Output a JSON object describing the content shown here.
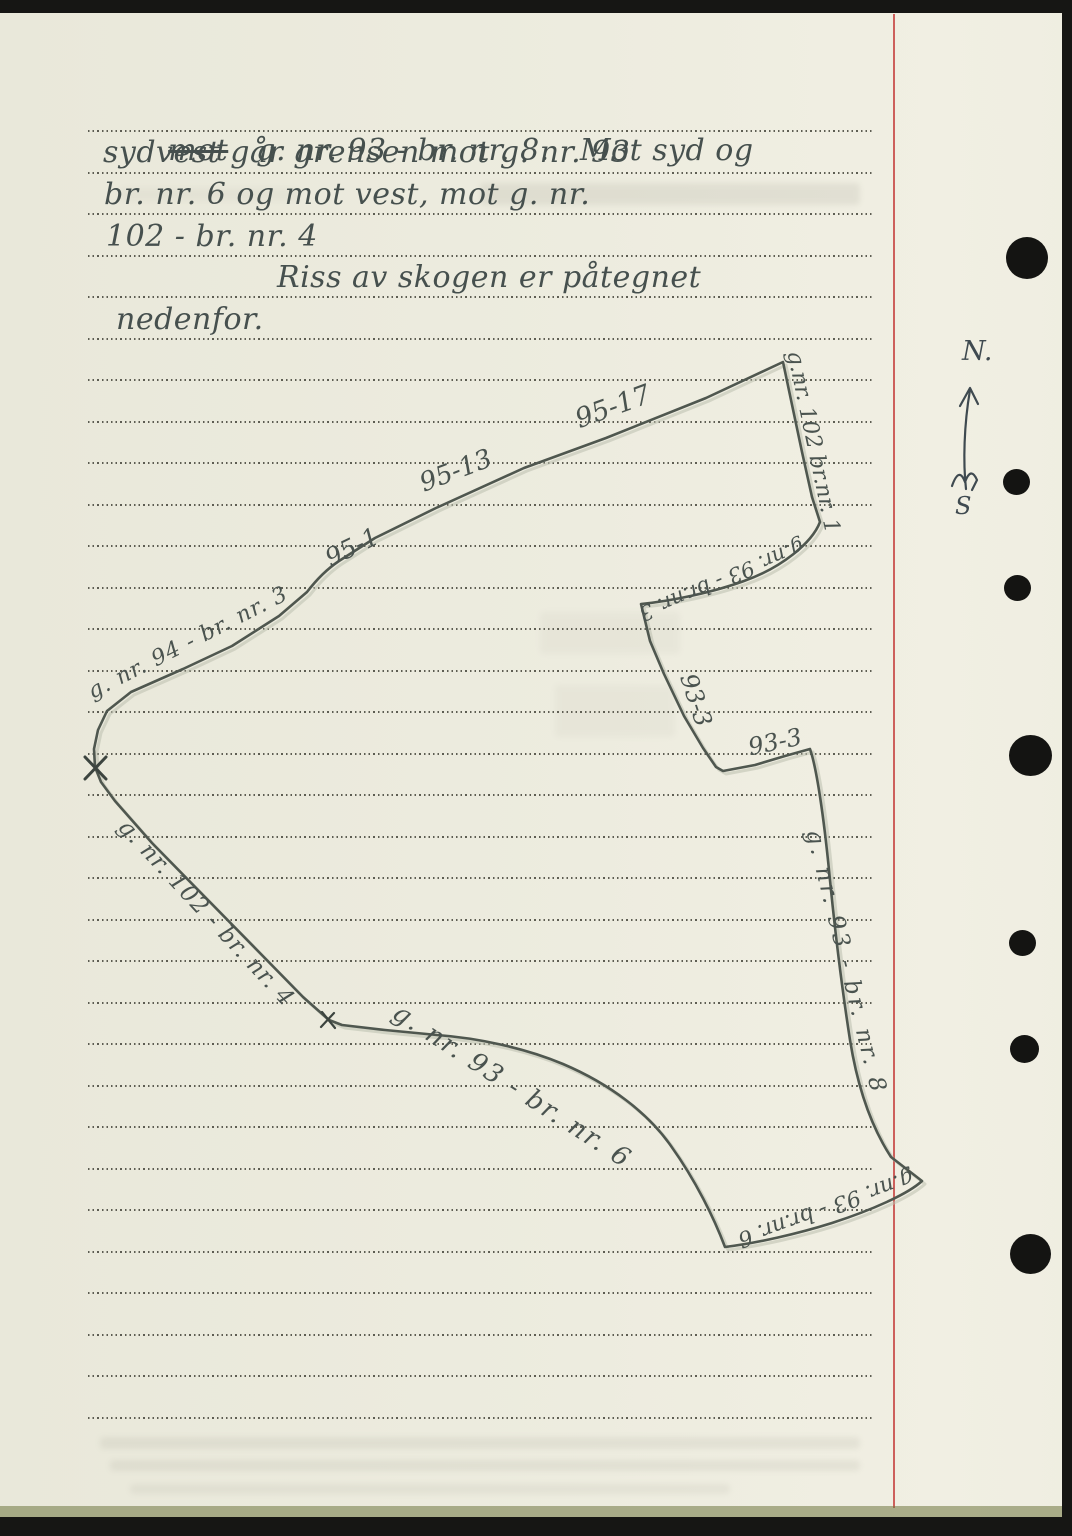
{
  "colors": {
    "paper": "#edecdf",
    "ink": "#46504e",
    "ruling_dots": "#303026",
    "red_margin_line": "#c9504c",
    "punch_hole": "#141412"
  },
  "note": {
    "line1_struck": "mot",
    "line1_rest": "g. nr. 93 - br. nr. 8.   Mot syd og",
    "line2": "sydvest går grensen mot g. nr. 93",
    "line3": "br. nr. 6 og mot vest, mot g. nr.",
    "line4": "102 - br. nr. 4",
    "line5": "Riss av skogen er påtegnet",
    "line6": "nedenfor."
  },
  "sketch": {
    "labels": [
      {
        "text": "95-1"
      },
      {
        "text": "95-13"
      },
      {
        "text": "95-17"
      },
      {
        "text": "g.nr. 102 br.nr. 1"
      },
      {
        "text": "g.nr. 93 - br.nr. 3"
      },
      {
        "text": "93-3"
      },
      {
        "text": "93-3"
      },
      {
        "text": "g. nr. 93 - br. nr. 8"
      },
      {
        "text": "g.nr. 93 - br.nr. 6"
      },
      {
        "text": "g. nr. 93 - br. nr. 6"
      },
      {
        "text": "g. nr. 102 - br. nr. 4"
      },
      {
        "text": "g. nr. 94 - br. nr. 3"
      }
    ],
    "compass": {
      "north": "N.",
      "south": "S"
    }
  }
}
